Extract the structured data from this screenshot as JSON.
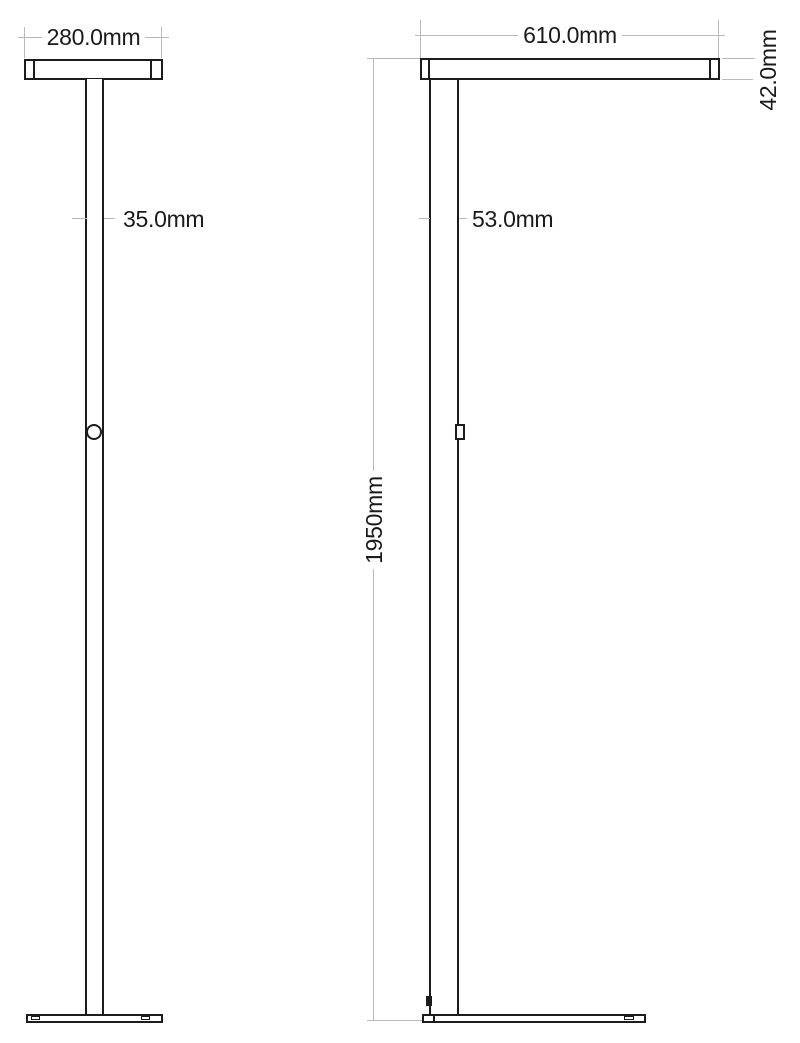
{
  "views": {
    "front": {
      "head_width": "280.0mm",
      "pole_width": "35.0mm"
    },
    "side": {
      "head_width": "610.0mm",
      "head_height": "42.0mm",
      "pole_depth": "53.0mm",
      "overall_height": "1950mm"
    }
  },
  "colors": {
    "part_outline": "#1c1c1c",
    "dimension_line": "#b9b9b9",
    "text": "#1a1a1a",
    "background": "#ffffff"
  }
}
